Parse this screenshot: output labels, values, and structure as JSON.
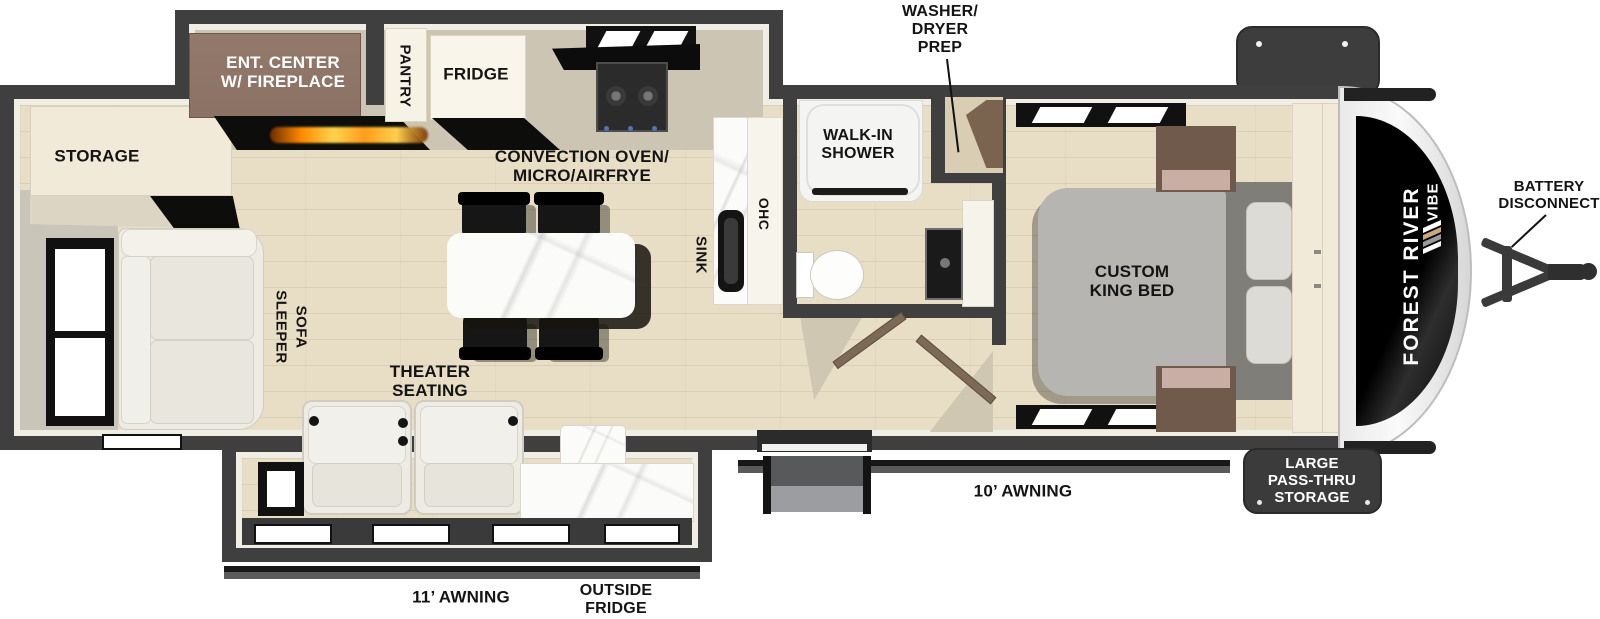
{
  "title": "Forest River Vibe travel trailer floorplan",
  "labels": {
    "washer_dryer_prep": "WASHER/\nDRYER\nPREP",
    "ent_center": "ENT. CENTER\nW/ FIREPLACE",
    "pantry": "PANTRY",
    "fridge": "FRIDGE",
    "convection": "CONVECTION OVEN/\nMICRO/AIRFRYE",
    "storage": "STORAGE",
    "walk_in_shower": "WALK-IN\nSHOWER",
    "sleeper_sofa_word1": "SLEEPER",
    "sleeper_sofa_word2": "SOFA",
    "theater_seating": "THEATER\nSEATING",
    "sink": "SINK",
    "ohc": "OHC",
    "custom_king_bed": "CUSTOM\nKING BED",
    "battery_disconnect": "BATTERY\nDISCONNECT",
    "awning_10": "10’ AWNING",
    "awning_11": "11’ AWNING",
    "outside_fridge": "OUTSIDE\nFRIDGE",
    "large_pass_thru": "LARGE\nPASS-THRU\nSTORAGE",
    "brand_line1": "FOREST RIVER",
    "brand_line2": "VIBE"
  },
  "colors": {
    "wall": "#3f3f3f",
    "floor_wood": "#e8dec6",
    "counter_tan": "#ccc4b2",
    "cabinet_cream": "#f2ead8",
    "ent_center_brown": "#8b7265",
    "door_brown": "#7c6a57",
    "bed_gray": "#b6b5b1",
    "flame_orange": "#ff9d1c",
    "chevron_tan": "#c8a87c",
    "label_black": "#141414",
    "front_cap_graphic": "#0d0d0d"
  }
}
